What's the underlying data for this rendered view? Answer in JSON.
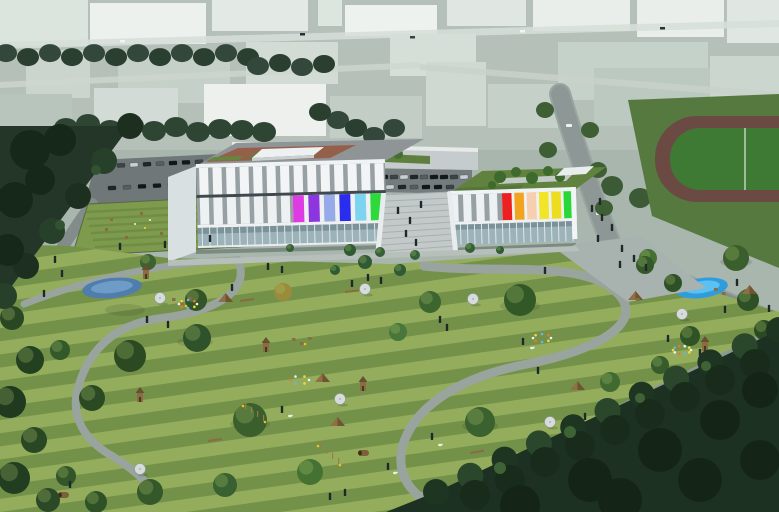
{
  "meta": {
    "type": "architectural-aerial-rendering",
    "title": "Aerial visualization: colorful school building with landscaped park",
    "visible_text": "none"
  },
  "scene": {
    "description": "Aerial architectural rendering of a two-wing school building with colored facade panels and rooftop gardens, fronted by a large striped-lawn park containing playground and agility equipment, parasols, ponds, winding paths and scattered people; ghosted pale context buildings and a running track in the background; dark forest bands frame the left and lower-right edges.",
    "building": {
      "left_wing_panels": [
        "#df3be4",
        "#8d35df",
        "#96aae8",
        "#2a2cee",
        "#7cd4ee",
        "#2ed93c"
      ],
      "right_wing_panels": [
        "#ee1f1f",
        "#f2a41f",
        "#f8cfae",
        "#f2e426",
        "#eedc1e",
        "#28d838"
      ],
      "facade": "#eaedee",
      "pillar_gap": "#97a1a4",
      "glass": "#9db3ba",
      "roof_terrace": "#95604a",
      "roof_garden": "#61823f"
    },
    "landscape": {
      "grass_light": "#93ad5c",
      "grass_dark": "#74914a",
      "forest": "#1d3122",
      "forest_left": "#233628",
      "pond_left": "#4f7dae",
      "pond_right": "#2f9ddd",
      "path": "#99a49f",
      "wood_equipment": "#8a6b42"
    },
    "background": {
      "base": "#a9b6ae",
      "ghost_building": "#e9eeea",
      "tree_row": "#33473a",
      "track_field": "#3f7a35",
      "track_ring": "#6b4a44",
      "road": "#8d9896"
    }
  }
}
